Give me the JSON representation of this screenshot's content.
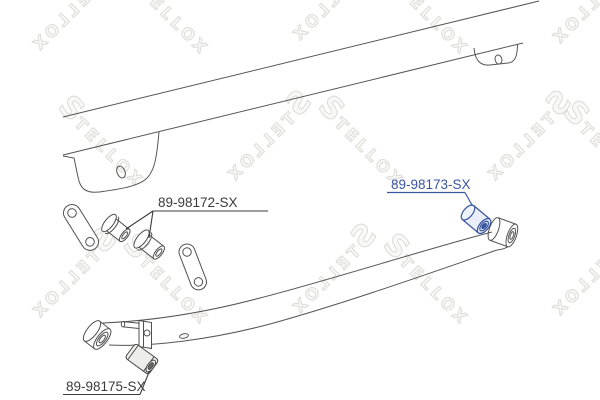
{
  "watermark": {
    "text": "STELLOX",
    "outline_color": "#dcdbd7"
  },
  "colors": {
    "background": "#ffffff",
    "drawing_line": "#555555",
    "label_text": "#3b3b3b",
    "highlight_blue": "#3a55a0"
  },
  "diagram": {
    "parts": [
      {
        "id": "shackle-bushings",
        "part_number": "89-98172-SX",
        "highlighted": false,
        "label_color": "#3b3b3b"
      },
      {
        "id": "rear-spring-eye-bushing",
        "part_number": "89-98173-SX",
        "highlighted": true,
        "label_color": "#3a55a0"
      },
      {
        "id": "front-spring-eye-bushing",
        "part_number": "89-98175-SX",
        "highlighted": false,
        "label_color": "#3b3b3b"
      }
    ]
  }
}
